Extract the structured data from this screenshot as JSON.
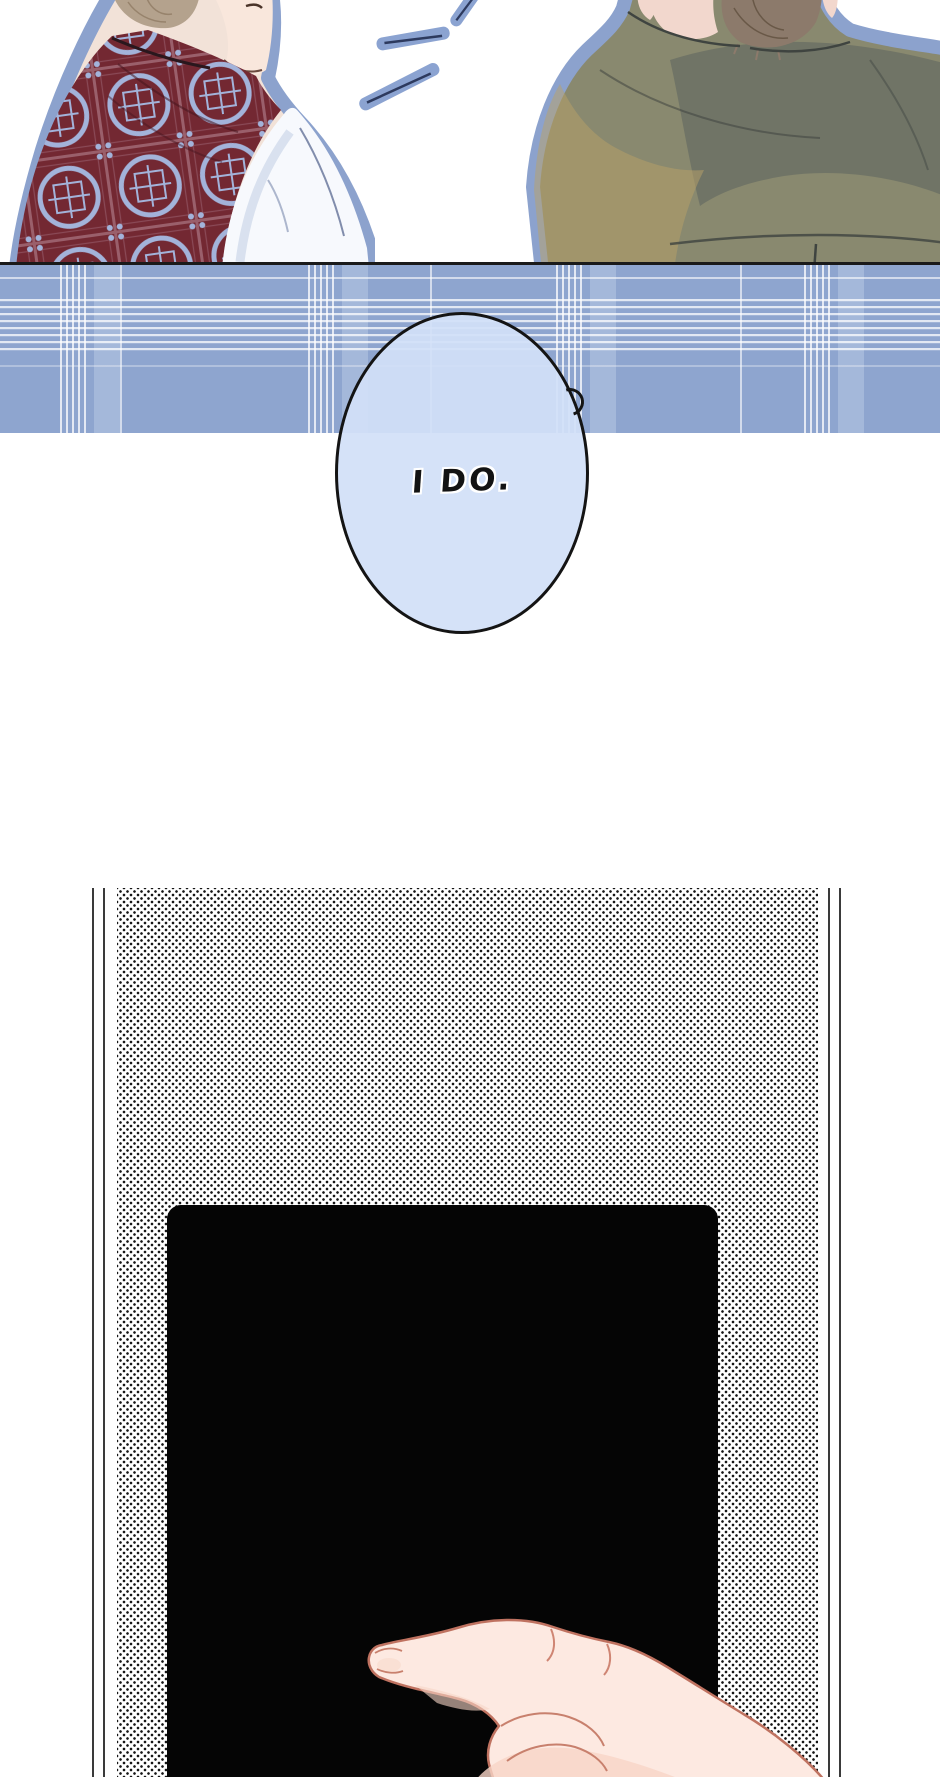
{
  "page": {
    "width": 940,
    "height": 1777,
    "background": "#ffffff",
    "kind": "webtoon comic page"
  },
  "top_panel": {
    "description": "Two figures seen from behind at a blue plaid table",
    "speech_bubble": {
      "text": "I DO.",
      "fill": "#d2e0f8",
      "outline": "#141414"
    },
    "colors": {
      "figure_outline": "#8ca2cd",
      "table_plaid_base": "#8ea5cf",
      "table_edge_line": "#1a1a1a",
      "vest": "#732832",
      "vest_pattern": "#a3b3da",
      "shirt": "#f7f9fd",
      "jacket": "#89896f",
      "hair_left": "#b4a28d",
      "hair_right": "#8c7a6b",
      "skin": "#f9e7dc",
      "emphasis_mark": "#8ba3d1"
    }
  },
  "bottom_panel": {
    "description": "Halftone panel with black device screen and pointing hand",
    "colors": {
      "halftone_dot": "#161616",
      "border_line": "#3a3a3a",
      "screen": "#050505",
      "hand_skin": "#fde9e1",
      "hand_outline": "#bf7260"
    }
  }
}
